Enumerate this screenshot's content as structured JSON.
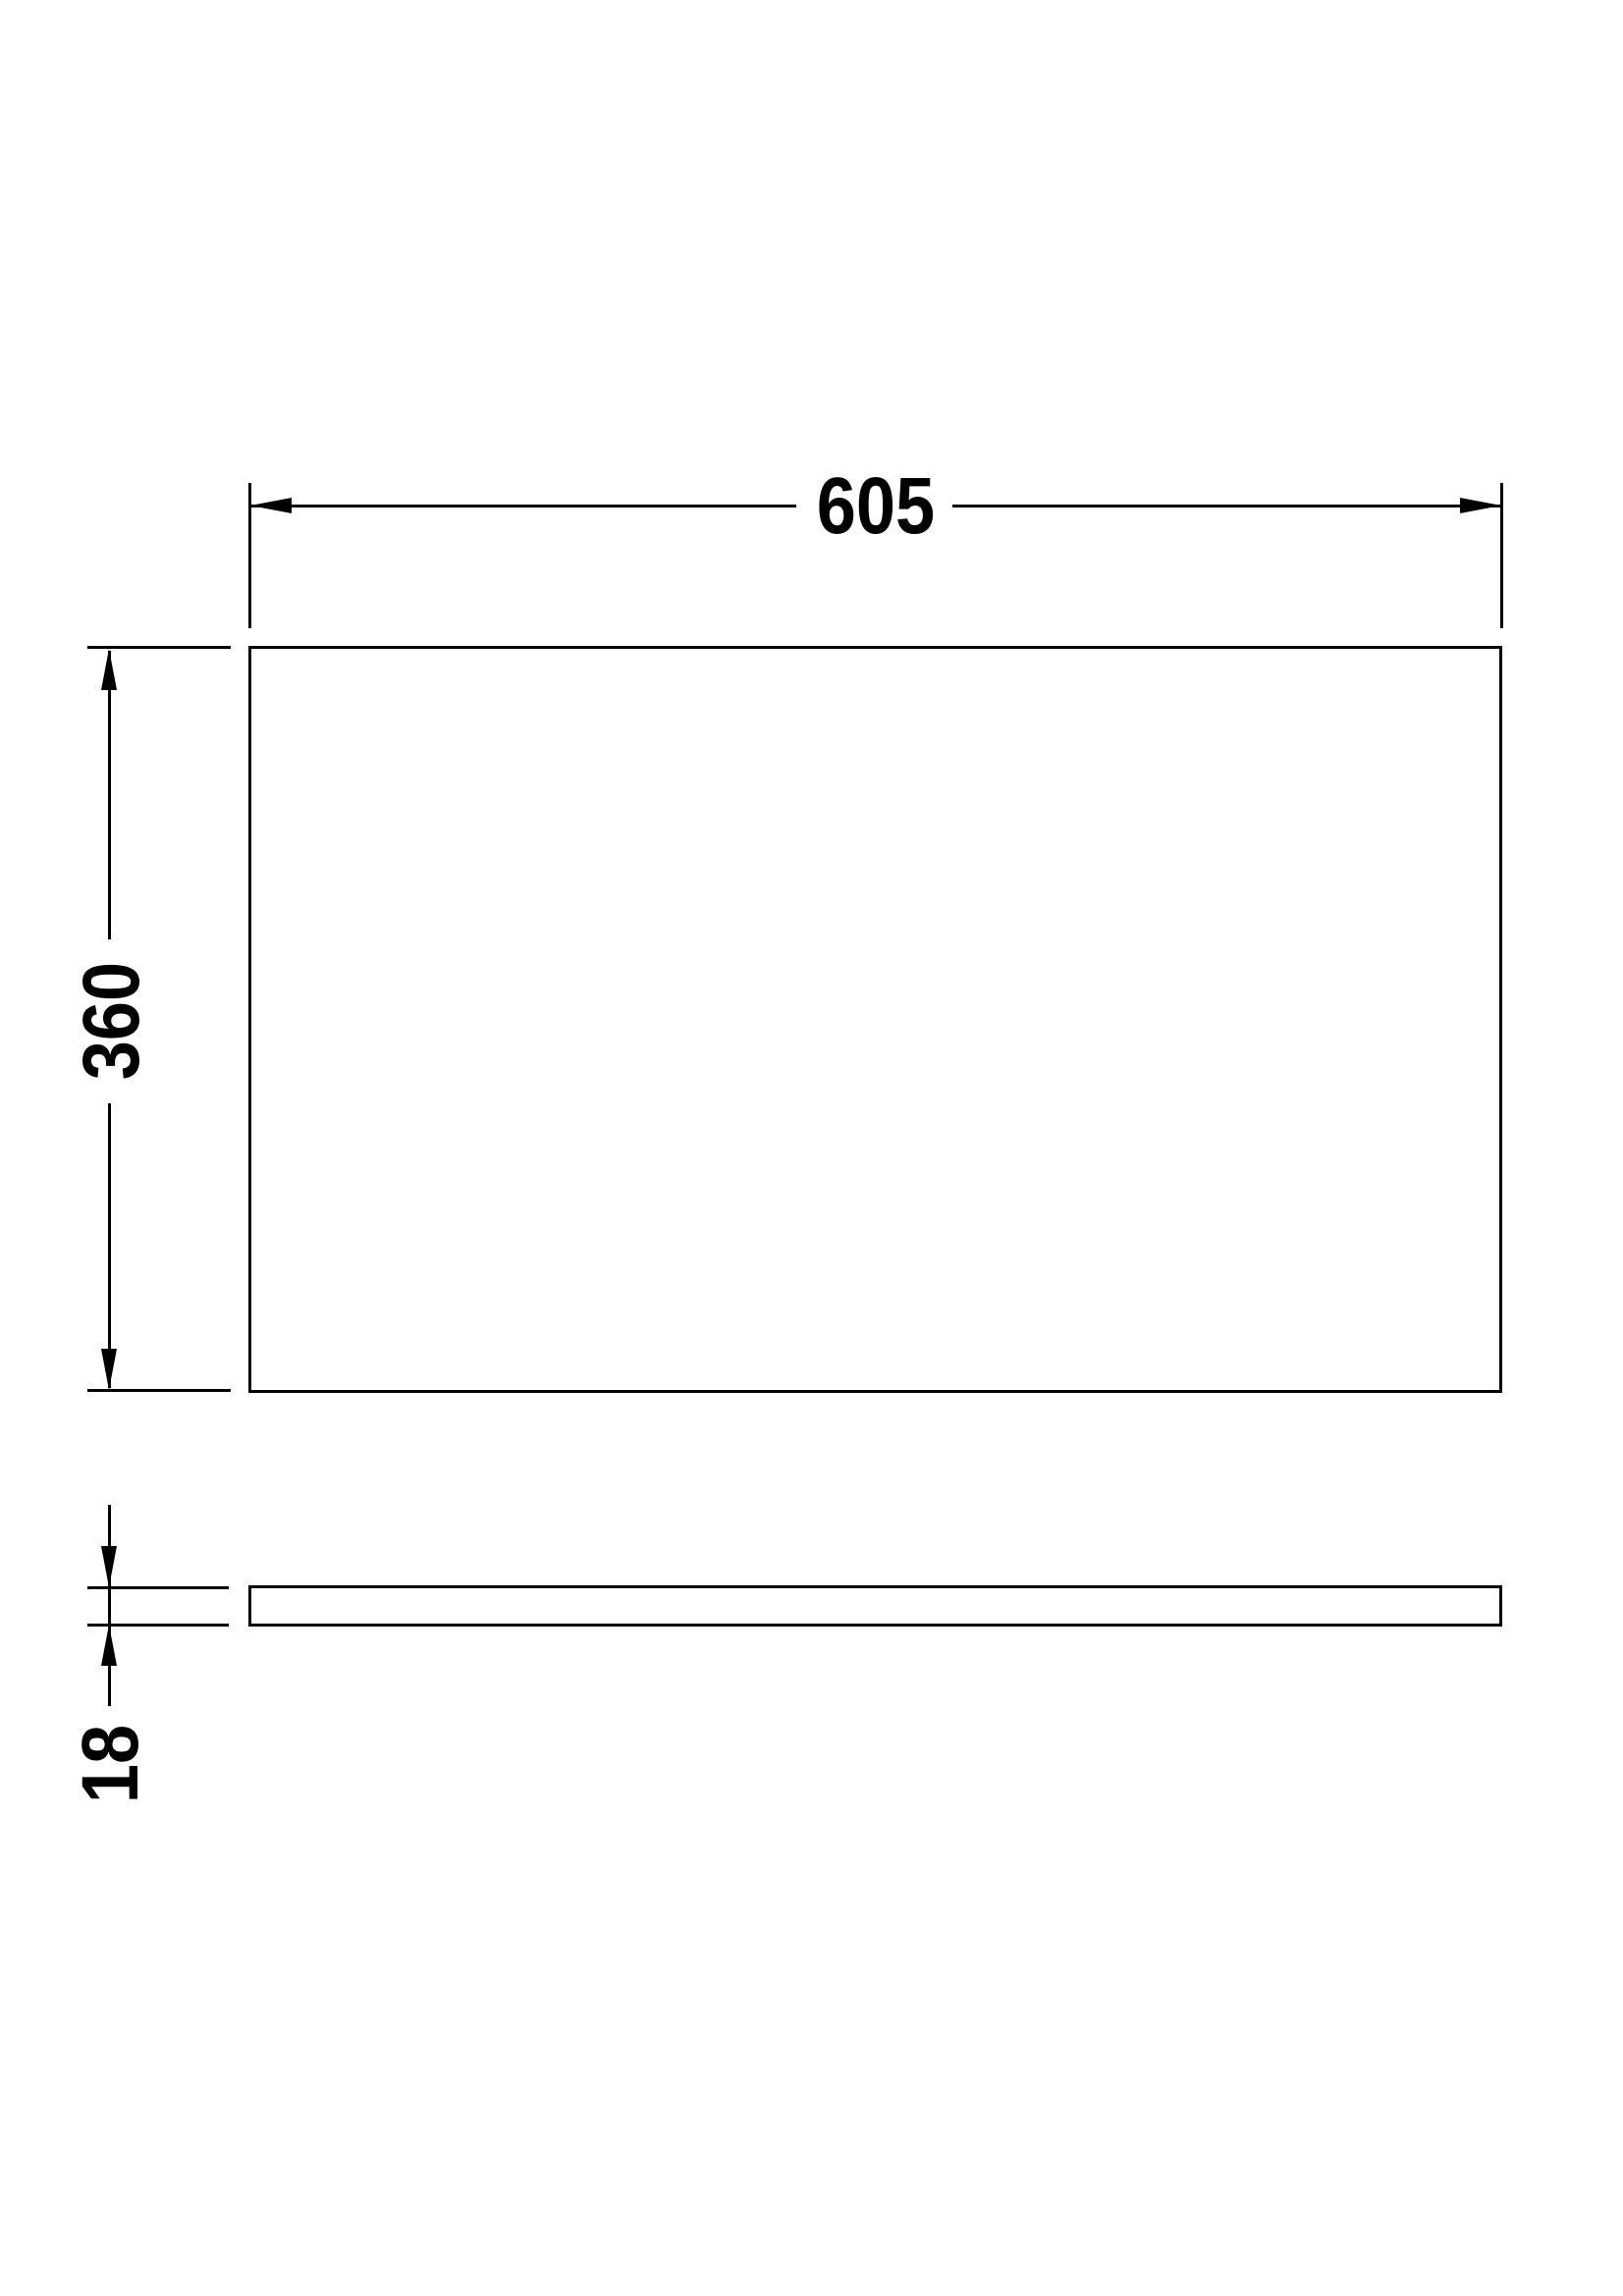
{
  "drawing": {
    "background_color": "#ffffff",
    "line_color": "#000000",
    "dimensions": {
      "width": {
        "label": "605",
        "value": 605,
        "orientation": "horizontal"
      },
      "height": {
        "label": "360",
        "value": 360,
        "orientation": "vertical"
      },
      "thickness": {
        "label": "18",
        "value": 18,
        "orientation": "vertical"
      }
    }
  }
}
